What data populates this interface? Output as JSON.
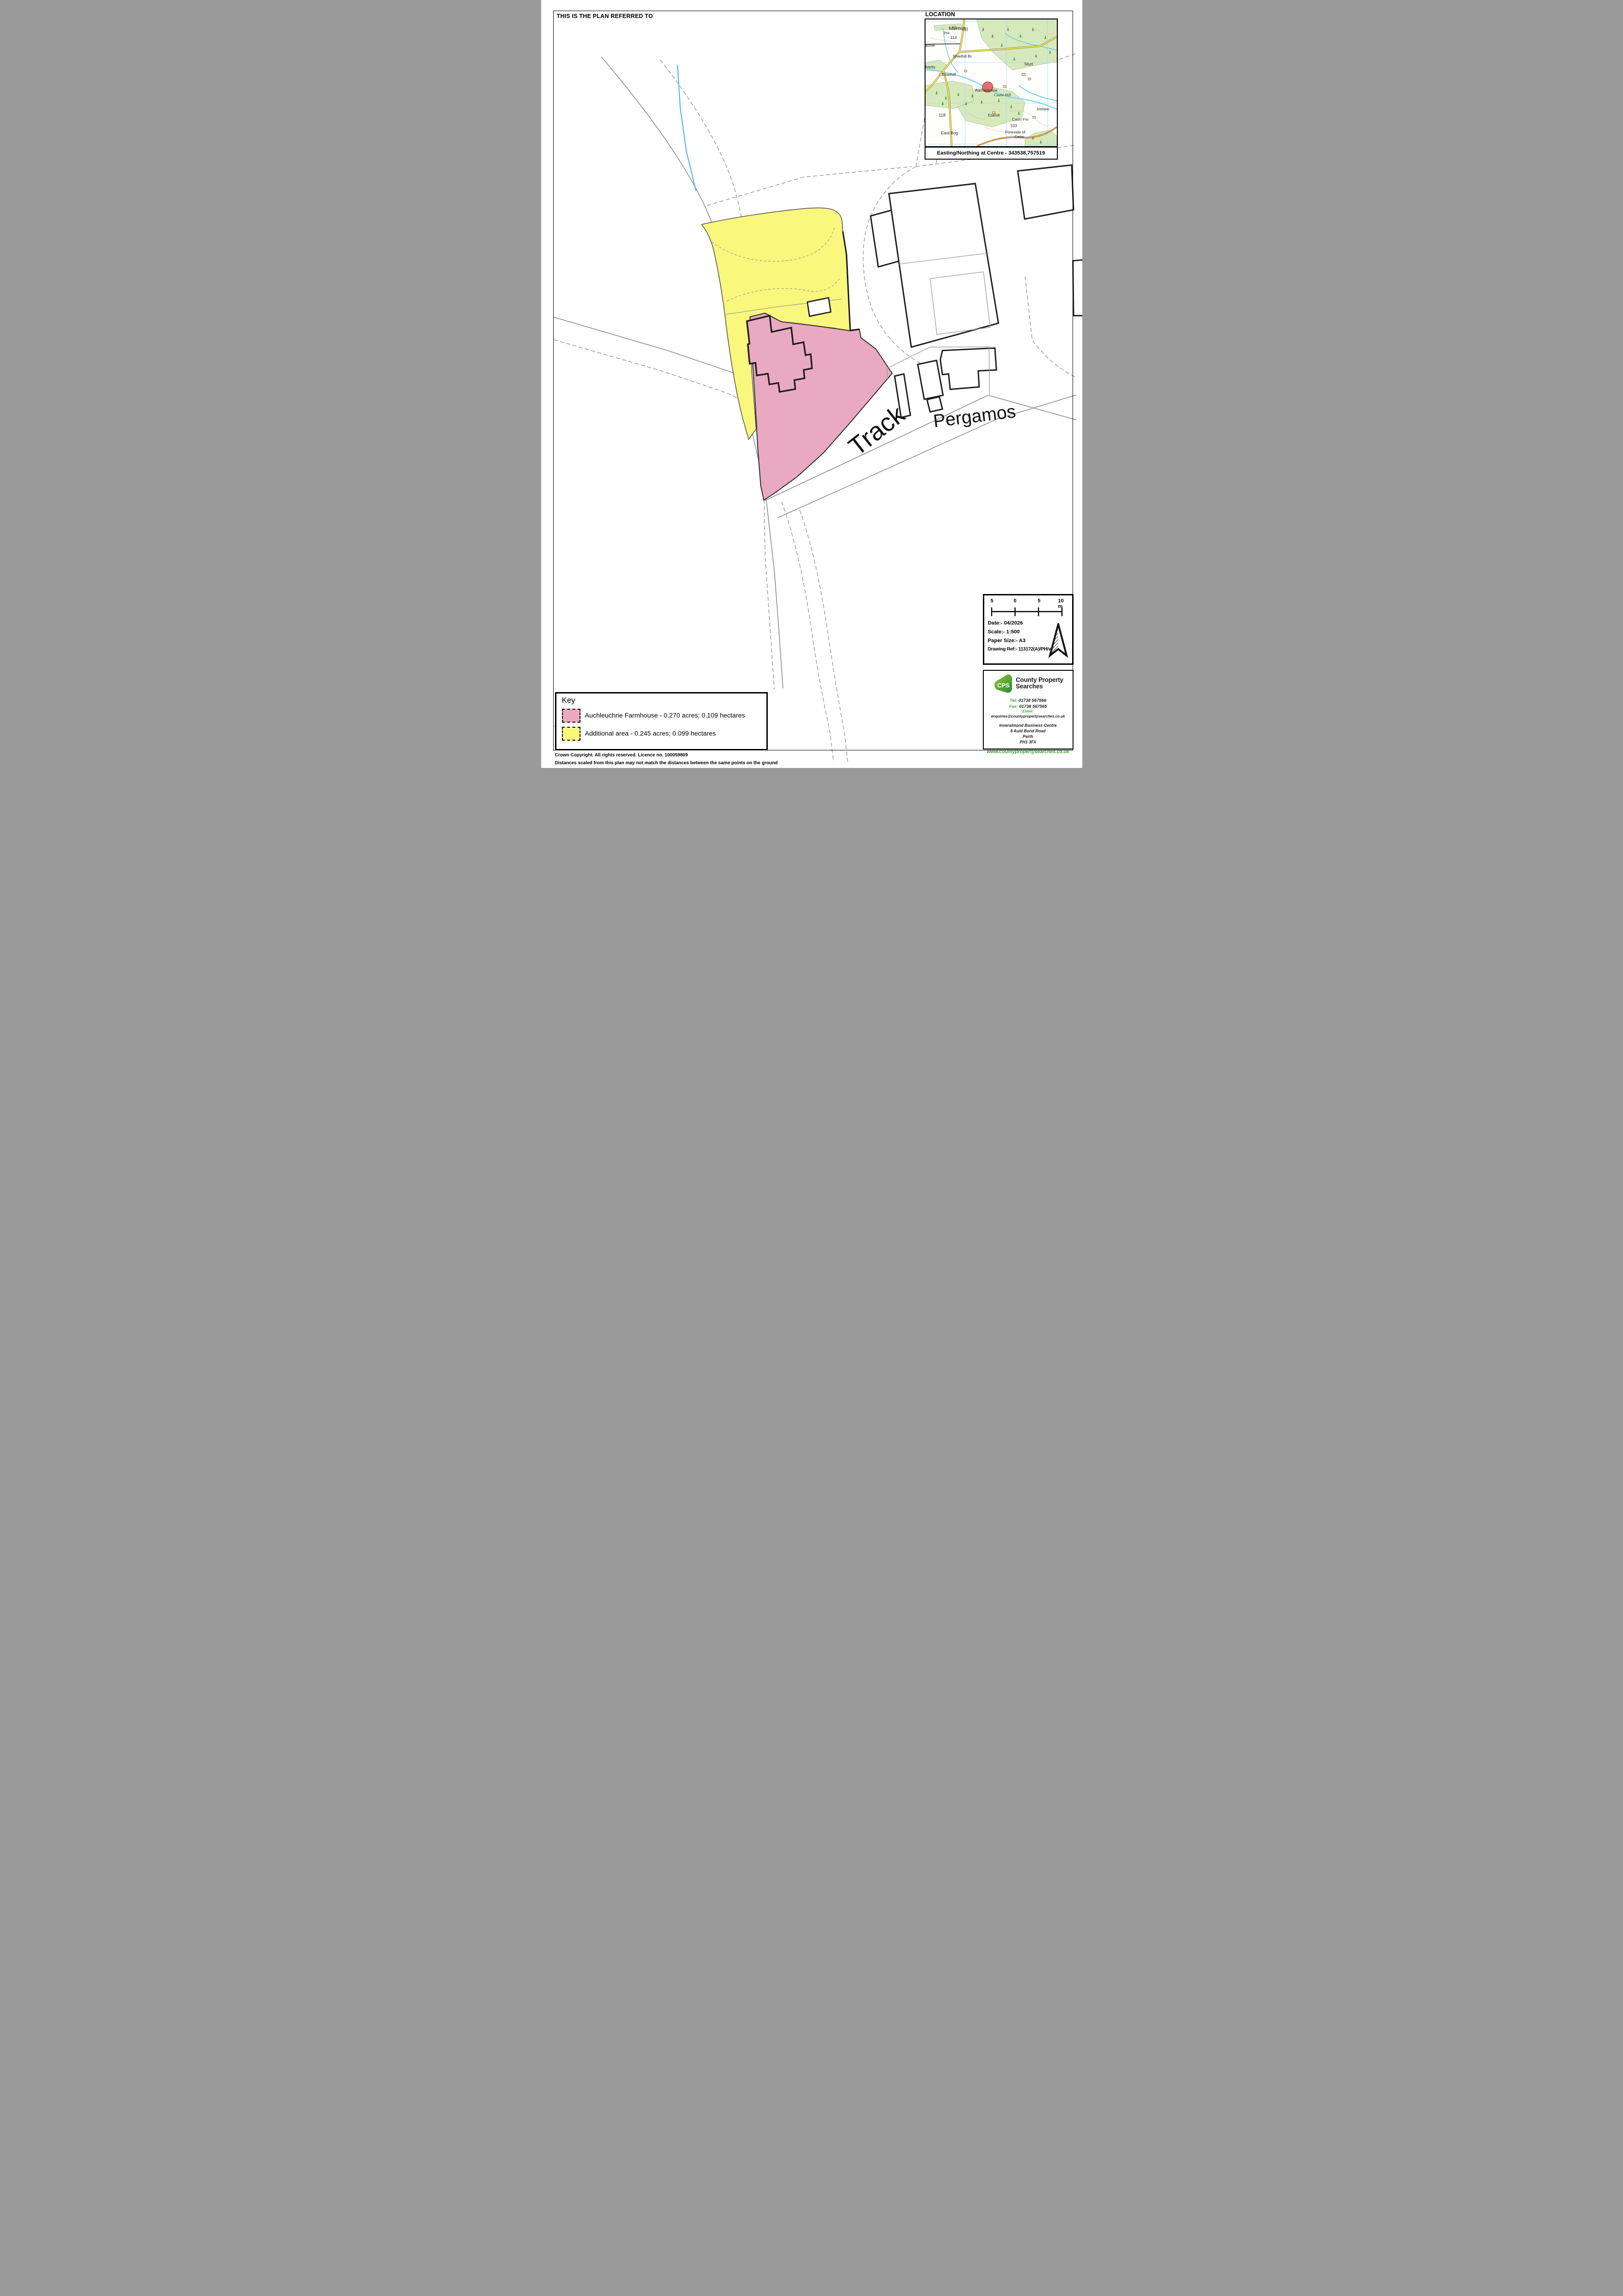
{
  "page": {
    "top_note": "THIS IS THE PLAN REFERRED TO",
    "footer_line1": "Crown Copyright. All rights reserved. Licence no. 100059809",
    "footer_line2": "Distances scaled from this plan may not match the distances between the same points on the ground"
  },
  "main_map": {
    "track_label": "Track",
    "road_label": "Pergamos"
  },
  "location_panel": {
    "title": "LOCATION",
    "caption": "Easting/Northing at Centre - 343538,757519",
    "labels": {
      "memus": "Memus",
      "ph": "PH",
      "n114": "114",
      "achie": "achie",
      "shielhill_br": "Shielhill Br",
      "harity": "harity",
      "shielhill": "Shielhill",
      "sturt": "Sturt",
      "auchleuchrie": "Auchleuchrie",
      "castle_hill": "Castle Hill",
      "eskhill": "Eskhill",
      "inshew": "Inshew",
      "n118": "118",
      "east_bog": "East Bog",
      "cairn_fm": "Cairn Fm",
      "n103": "103",
      "foreside_of": "Foreside of",
      "cairn": "Cairn"
    }
  },
  "key_panel": {
    "title": "Key",
    "items": [
      {
        "label": "Auchleuchrie Farmhouse - 0.270 acres; 0.109 hectares",
        "color": "#E9A9C1"
      },
      {
        "label": "Additional area - 0.245 acres; 0.099 hectares",
        "color": "#F9F77C"
      }
    ]
  },
  "info_panel": {
    "scale_ticks": [
      "5",
      "0",
      "5",
      "10 m"
    ],
    "date": "Date:- 04/2026",
    "scale": "Scale:- 1:500",
    "paper": "Paper Size:- A3",
    "ref": "Drawing Ref:- 113172(A)/PH/v1"
  },
  "company_panel": {
    "logo": "CPS",
    "name1": "County Property",
    "name2": "Searches",
    "tel_label": "Tel:",
    "tel_value": "01738 567566",
    "fax_label": "Fax:",
    "fax_value": "01738 567565",
    "email_label": "Email:",
    "email_value": "enquiries@countypropertysearches.co.uk",
    "address1": "Inveralmond Business Centre",
    "address2": "6 Auld Bond Road",
    "address3": "Perth",
    "address4": "PH1 3FX",
    "website": "www.countypropertysearches.co.uk"
  },
  "colors": {
    "parcel_pink": "#E9A9C1",
    "parcel_yellow": "#F9F77C",
    "road_gray": "#8F8F8F",
    "stream_blue": "#45AEF0",
    "os_wood_green": "#D6E9BC",
    "os_road_yellow": "#EFE93F",
    "site_marker_red": "#E05A5A",
    "cps_green": "#3AAA35"
  }
}
